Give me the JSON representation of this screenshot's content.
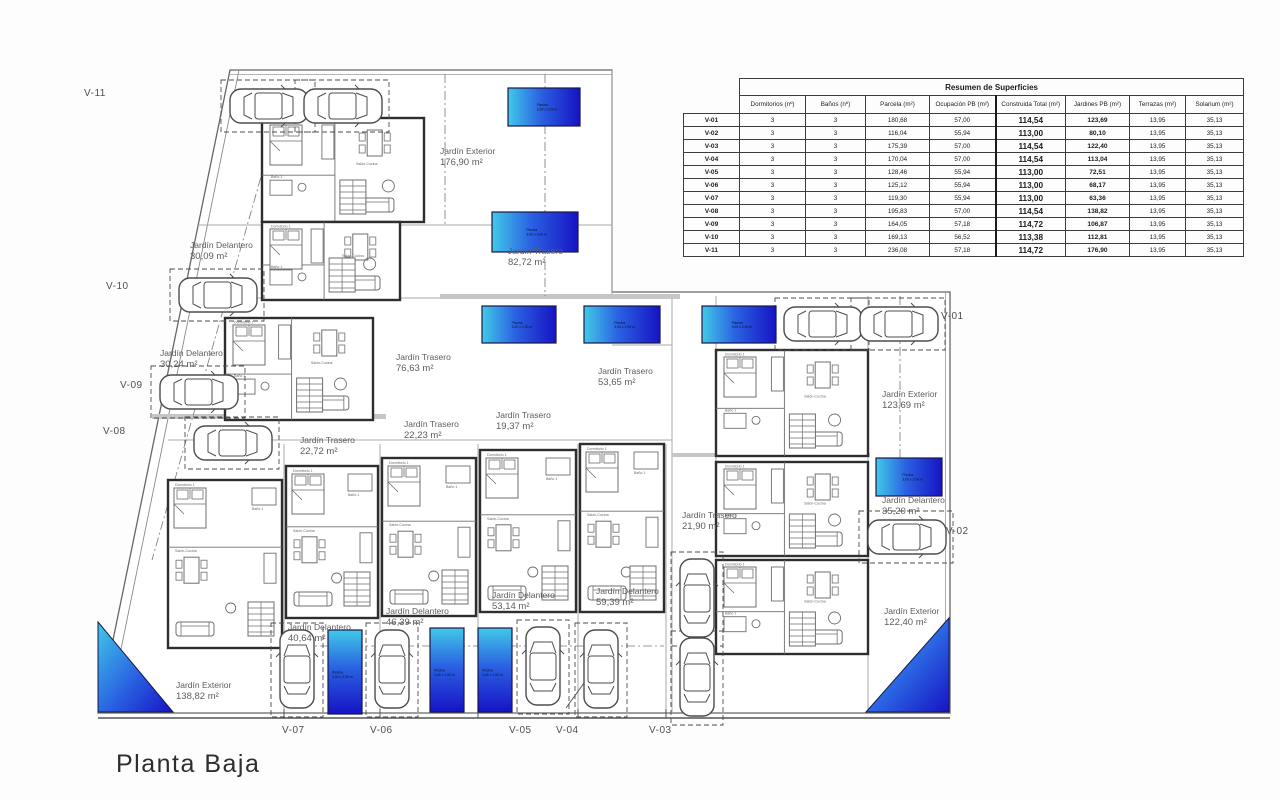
{
  "title": "Planta Baja",
  "table": {
    "title": "Resumen de Superficies",
    "columns": [
      "",
      "Dormitorios (nº)",
      "Baños (nº)",
      "Parcela (m²)",
      "Ocupación PB (m²)",
      "Construida Total (m²)",
      "Jardines PB (m²)",
      "Terrazas (m²)",
      "Solarium (m²)"
    ],
    "rows": [
      [
        "V-01",
        "3",
        "3",
        "180,68",
        "57,00",
        "114,54",
        "123,69",
        "13,95",
        "35,13"
      ],
      [
        "V-02",
        "3",
        "3",
        "116,04",
        "55,94",
        "113,00",
        "80,10",
        "13,95",
        "35,13"
      ],
      [
        "V-03",
        "3",
        "3",
        "175,39",
        "57,00",
        "114,54",
        "122,40",
        "13,95",
        "35,13"
      ],
      [
        "V-04",
        "3",
        "3",
        "170,04",
        "57,00",
        "114,54",
        "113,04",
        "13,95",
        "35,13"
      ],
      [
        "V-05",
        "3",
        "3",
        "128,46",
        "55,94",
        "113,00",
        "72,51",
        "13,95",
        "35,13"
      ],
      [
        "V-06",
        "3",
        "3",
        "125,12",
        "55,94",
        "113,00",
        "68,17",
        "13,95",
        "35,13"
      ],
      [
        "V-07",
        "3",
        "3",
        "119,30",
        "55,94",
        "113,00",
        "63,36",
        "13,95",
        "35,13"
      ],
      [
        "V-08",
        "3",
        "3",
        "195,83",
        "57,00",
        "114,54",
        "138,82",
        "13,95",
        "35,13"
      ],
      [
        "V-09",
        "3",
        "3",
        "164,05",
        "57,18",
        "114,72",
        "106,87",
        "13,95",
        "35,13"
      ],
      [
        "V-10",
        "3",
        "3",
        "169,13",
        "56,52",
        "113,38",
        "112,81",
        "13,95",
        "35,13"
      ],
      [
        "V-11",
        "3",
        "3",
        "236,08",
        "57,18",
        "114,72",
        "176,90",
        "13,95",
        "35,13"
      ]
    ]
  },
  "plan": {
    "pool_label": {
      "line1": "Piscina",
      "line2": "3,00 x 2,00 m"
    },
    "room_labels": {
      "bedroom": "Dormitorio 1",
      "bath": "Baño 1",
      "living": "Salón-Cocina"
    },
    "colors": {
      "pool_light": "#41c9e8",
      "pool_mid": "#2a62e2",
      "pool_dark": "#1713c4"
    },
    "unit_labels": [
      {
        "id": "V-11",
        "x": 84,
        "y": 88
      },
      {
        "id": "V-10",
        "x": 106,
        "y": 281
      },
      {
        "id": "V-09",
        "x": 120,
        "y": 380
      },
      {
        "id": "V-08",
        "x": 103,
        "y": 426
      },
      {
        "id": "V-07",
        "x": 282,
        "y": 725
      },
      {
        "id": "V-06",
        "x": 370,
        "y": 725
      },
      {
        "id": "V-05",
        "x": 509,
        "y": 725
      },
      {
        "id": "V-04",
        "x": 556,
        "y": 725
      },
      {
        "id": "V-03",
        "x": 649,
        "y": 725
      },
      {
        "id": "V-02",
        "x": 946,
        "y": 526
      },
      {
        "id": "V-01",
        "x": 941,
        "y": 311
      }
    ],
    "garden_labels": [
      {
        "name": "Jardín Exterior",
        "area": "176,90 m²",
        "x": 440,
        "y": 146
      },
      {
        "name": "Jardín Delantero",
        "area": "30,09 m²",
        "x": 190,
        "y": 240
      },
      {
        "name": "Jardín Trasero",
        "area": "82,72 m²",
        "x": 508,
        "y": 246
      },
      {
        "name": "Jardín Delantero",
        "area": "30,24 m²",
        "x": 160,
        "y": 348
      },
      {
        "name": "Jardín Trasero",
        "area": "76,63 m²",
        "x": 396,
        "y": 352
      },
      {
        "name": "Jardín Trasero",
        "area": "53,65 m²",
        "x": 598,
        "y": 366
      },
      {
        "name": "Jardín Trasero",
        "area": "19,37 m²",
        "x": 496,
        "y": 410
      },
      {
        "name": "Jardín Trasero",
        "area": "22,23 m²",
        "x": 404,
        "y": 419
      },
      {
        "name": "Jardín Trasero",
        "area": "22,72 m²",
        "x": 300,
        "y": 435
      },
      {
        "name": "Jardín Exterior",
        "area": "123,69 m²",
        "x": 882,
        "y": 389
      },
      {
        "name": "Jardín Trasero",
        "area": "21,90 m²",
        "x": 682,
        "y": 510
      },
      {
        "name": "Jardín Delantero",
        "area": "35,20 m²",
        "x": 882,
        "y": 495
      },
      {
        "name": "Jardín Delantero",
        "area": "59,39 m²",
        "x": 596,
        "y": 586
      },
      {
        "name": "Jardín Delantero",
        "area": "53,14 m²",
        "x": 492,
        "y": 590
      },
      {
        "name": "Jardín Delantero",
        "area": "46,39 m²",
        "x": 386,
        "y": 606
      },
      {
        "name": "Jardín Delantero",
        "area": "40,64 m²",
        "x": 288,
        "y": 622
      },
      {
        "name": "Jardín Exterior",
        "area": "138,82 m²",
        "x": 176,
        "y": 680
      },
      {
        "name": "Jardín Exterior",
        "area": "122,40 m²",
        "x": 884,
        "y": 606
      }
    ],
    "pools": [
      {
        "x": 508,
        "y": 88,
        "w": 72,
        "h": 38,
        "o": "h"
      },
      {
        "x": 492,
        "y": 212,
        "w": 86,
        "h": 40,
        "o": "h"
      },
      {
        "x": 482,
        "y": 306,
        "w": 74,
        "h": 37,
        "o": "h"
      },
      {
        "x": 584,
        "y": 306,
        "w": 76,
        "h": 37,
        "o": "h"
      },
      {
        "x": 702,
        "y": 306,
        "w": 74,
        "h": 37,
        "o": "h"
      },
      {
        "x": 876,
        "y": 458,
        "w": 66,
        "h": 38,
        "o": "h"
      },
      {
        "x": 328,
        "y": 630,
        "w": 34,
        "h": 84,
        "o": "v"
      },
      {
        "x": 430,
        "y": 628,
        "w": 34,
        "h": 84,
        "o": "v"
      },
      {
        "x": 478,
        "y": 628,
        "w": 34,
        "h": 84,
        "o": "v"
      }
    ],
    "corner_pools": [
      {
        "points": "98,622 173,712 98,712"
      },
      {
        "points": "949,618 949,712 866,712"
      }
    ],
    "cars": [
      {
        "x": 268,
        "y": 106,
        "r": 90
      },
      {
        "x": 342,
        "y": 106,
        "r": 90
      },
      {
        "x": 217,
        "y": 295,
        "r": 90
      },
      {
        "x": 198,
        "y": 392,
        "r": 90
      },
      {
        "x": 232,
        "y": 443,
        "r": 90
      },
      {
        "x": 297,
        "y": 670,
        "r": 0
      },
      {
        "x": 392,
        "y": 670,
        "r": 0
      },
      {
        "x": 543,
        "y": 667,
        "r": 0
      },
      {
        "x": 601,
        "y": 670,
        "r": 0
      },
      {
        "x": 697,
        "y": 599,
        "r": 0
      },
      {
        "x": 697,
        "y": 678,
        "r": 0
      },
      {
        "x": 822,
        "y": 324,
        "r": 90
      },
      {
        "x": 898,
        "y": 324,
        "r": 90
      },
      {
        "x": 906,
        "y": 537,
        "r": 90
      }
    ],
    "houses": [
      {
        "x": 262,
        "y": 118,
        "w": 162,
        "h": 104,
        "v": "h"
      },
      {
        "x": 262,
        "y": 222,
        "w": 138,
        "h": 78,
        "v": "h"
      },
      {
        "x": 225,
        "y": 318,
        "w": 148,
        "h": 102,
        "v": "h"
      },
      {
        "x": 168,
        "y": 480,
        "w": 114,
        "h": 168,
        "v": "v"
      },
      {
        "x": 286,
        "y": 466,
        "w": 92,
        "h": 152,
        "v": "v"
      },
      {
        "x": 382,
        "y": 458,
        "w": 94,
        "h": 158,
        "v": "v"
      },
      {
        "x": 480,
        "y": 450,
        "w": 96,
        "h": 162,
        "v": "v"
      },
      {
        "x": 580,
        "y": 444,
        "w": 84,
        "h": 168,
        "v": "v"
      },
      {
        "x": 716,
        "y": 350,
        "w": 152,
        "h": 106,
        "v": "h"
      },
      {
        "x": 716,
        "y": 462,
        "w": 152,
        "h": 94,
        "v": "h"
      },
      {
        "x": 716,
        "y": 560,
        "w": 152,
        "h": 94,
        "v": "h"
      }
    ]
  }
}
